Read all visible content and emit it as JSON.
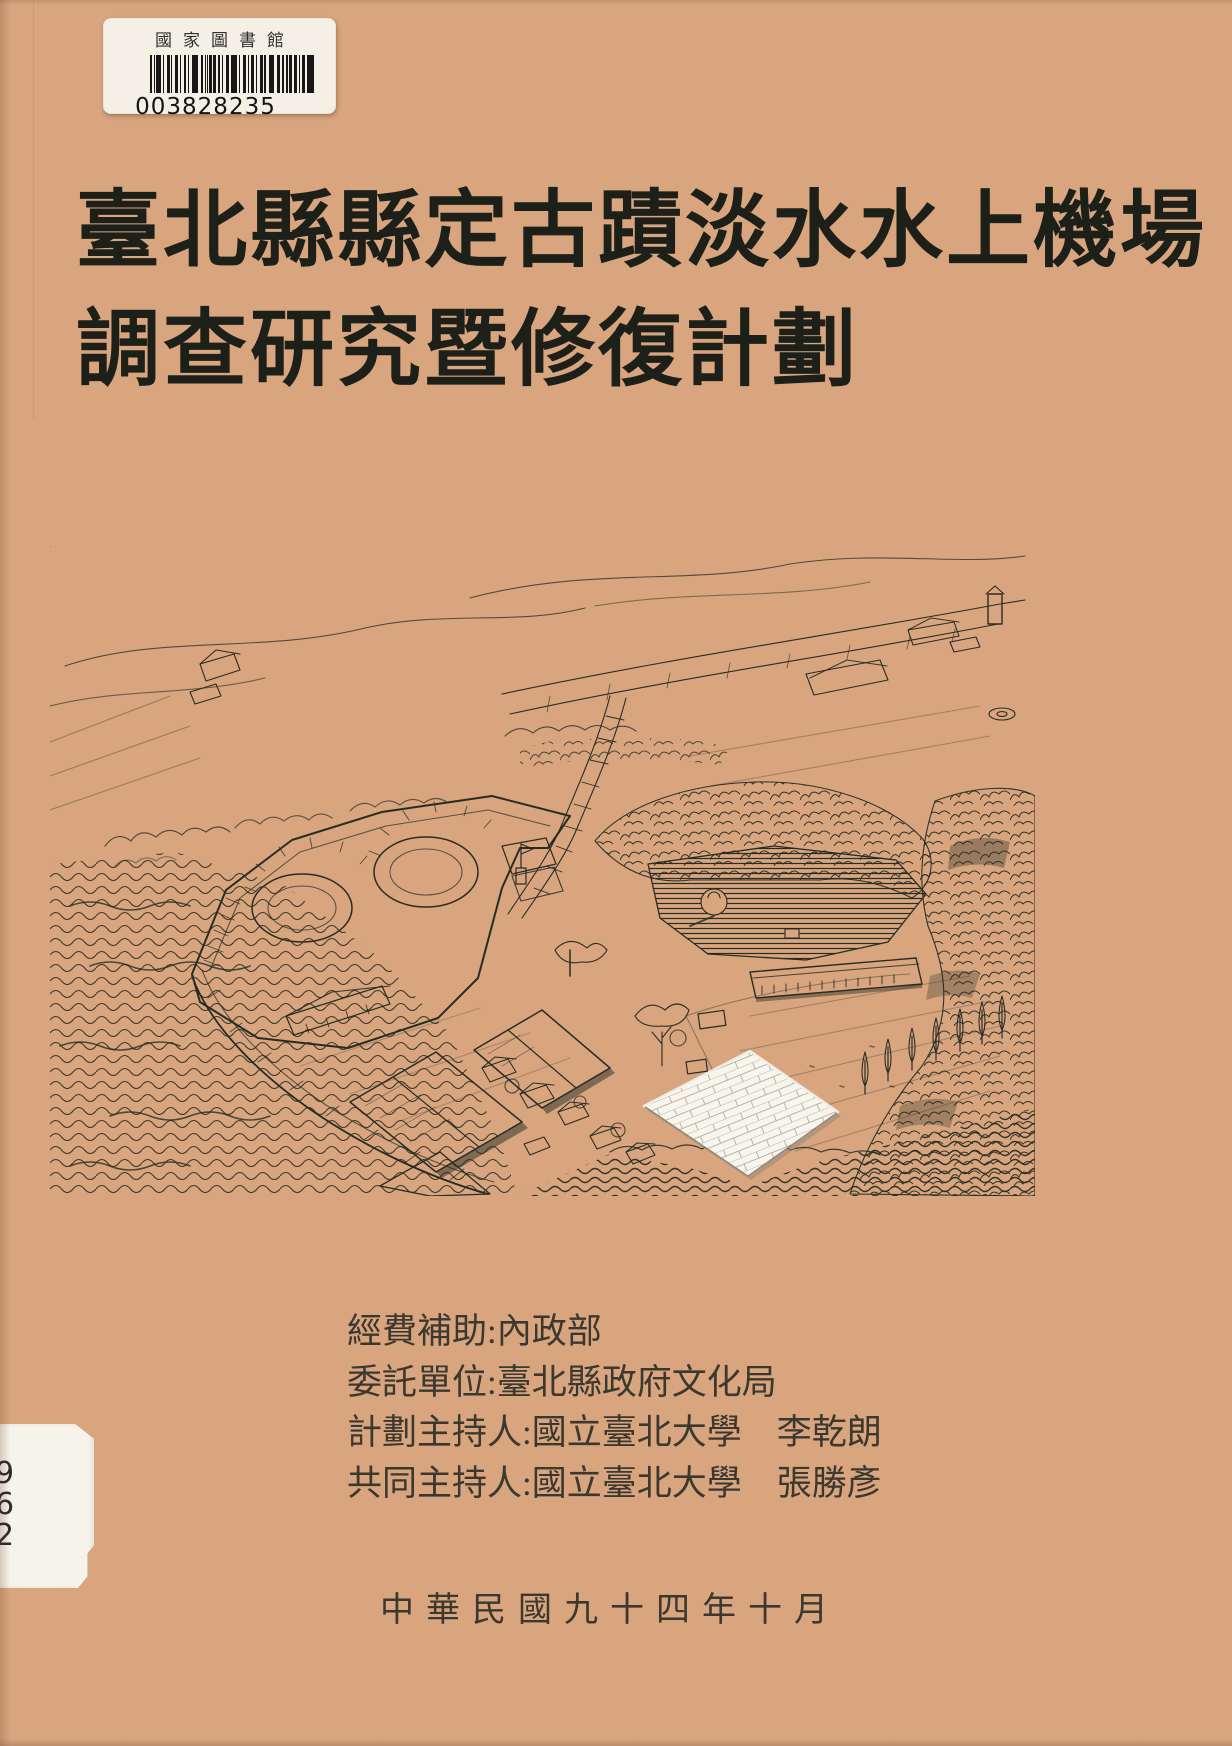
{
  "colors": {
    "cover_background": "#d8a57f",
    "ink": "#272d24",
    "label_background": "#f4f0e5"
  },
  "library_label": {
    "library_name": "國家圖書館",
    "barcode_number": "003828235",
    "barcode_icon": "barcode"
  },
  "title": {
    "line1": "臺北縣縣定古蹟淡水水上機場",
    "line2": "調查研究暨修復計劃"
  },
  "credits": {
    "lines": [
      "經費補助:內政部",
      "委託單位:臺北縣政府文化局",
      "計劃主持人:國立臺北大學　李乾朗",
      "共同主持人:國立臺北大學　張勝彥"
    ]
  },
  "date_line": "中華民國九十四年十月",
  "call_number_label": {
    "digits": [
      "9",
      "6",
      "2"
    ]
  }
}
